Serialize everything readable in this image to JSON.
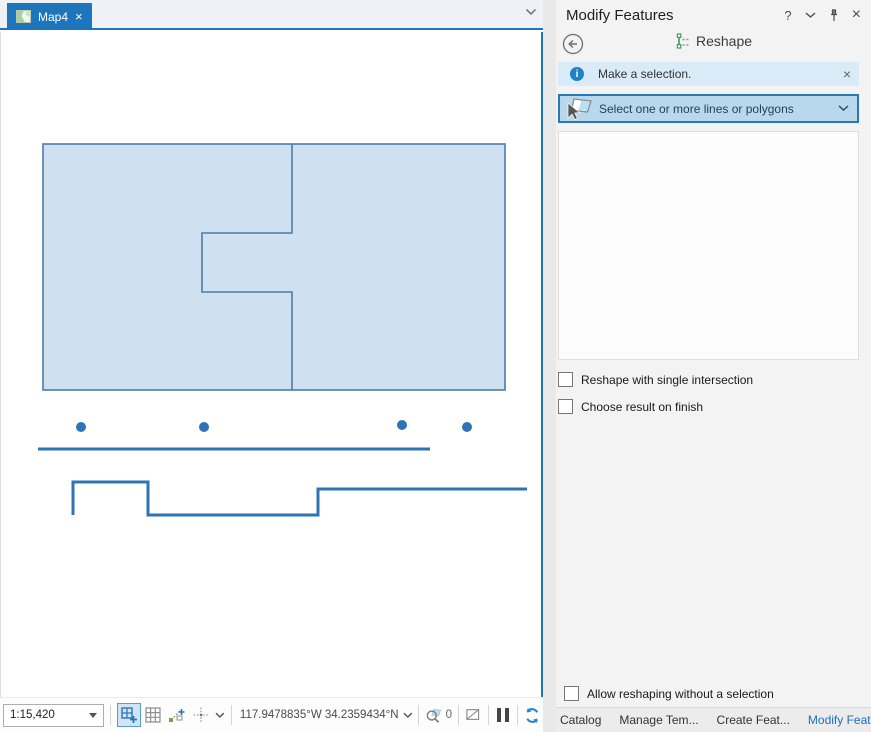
{
  "map_view": {
    "tab_label": "Map4",
    "close_glyph": "×"
  },
  "statusbar": {
    "scale": "1:15,420",
    "coordinates": "117.9478835°W 34.2359434°N",
    "selection_count": "0"
  },
  "panel": {
    "title": "Modify Features",
    "help_glyph": "?",
    "close_glyph": "×",
    "tool": "Reshape",
    "info": "Make a selection.",
    "info_glyph": "i",
    "info_close_glyph": "×",
    "selector": "Select one or more lines or polygons",
    "options": [
      {
        "label": "Reshape with single intersection",
        "checked": false
      },
      {
        "label": "Choose result on finish",
        "checked": false
      }
    ],
    "footer_option": {
      "label": "Allow reshaping without a selection",
      "checked": false
    },
    "dock_tabs": [
      {
        "label": "Catalog",
        "active": false
      },
      {
        "label": "Manage Tem...",
        "active": false
      },
      {
        "label": "Create Feat...",
        "active": false
      },
      {
        "label": "Modify Feat...",
        "active": true
      }
    ]
  },
  "colors": {
    "accent": "#1d76bb",
    "polygon_fill": "#cfe0f0",
    "polygon_stroke": "#4d7ca8",
    "feature_line": "#2e74b5",
    "active_dock_tab_text": "#1a70c4",
    "selector_bg": "#b9d8ed",
    "selector_border": "#2778b5",
    "info_bg": "#d9ebf7"
  },
  "map_shapes": {
    "dot_radius": 5,
    "outer": {
      "x": 42,
      "y": 112,
      "w": 462,
      "h": 246
    },
    "divider_d": "M291 112 L291 201 L201 201 L201 260 L291 260 L291 358",
    "dots": [
      {
        "x": 80,
        "y": 395
      },
      {
        "x": 203,
        "y": 395
      },
      {
        "x": 401,
        "y": 393
      },
      {
        "x": 466,
        "y": 395
      }
    ],
    "baseline_d": "M37 417 L429 417",
    "step_line_d": "M72 483 L72 450 L147 450 L147 483 L317 483 L317 457 L526 457"
  }
}
